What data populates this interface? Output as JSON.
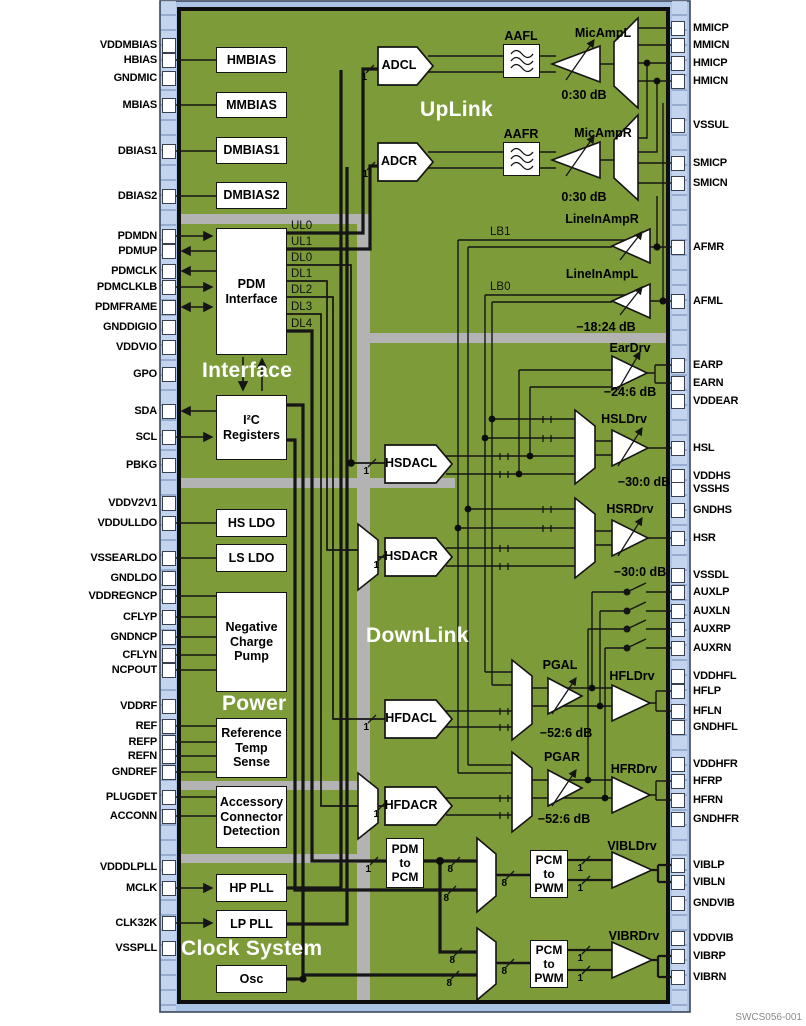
{
  "doc_code": "SWCS056-001",
  "sections": {
    "uplink": "UpLink",
    "downlink": "DownLink",
    "interface": "Interface",
    "power": "Power",
    "clock": "Clock System"
  },
  "blocks": {
    "hmbias": "HMBIAS",
    "mmbias": "MMBIAS",
    "dmbias1": "DMBIAS1",
    "dmbias2": "DMBIAS2",
    "pdm": {
      "l1": "PDM",
      "l2": "Interface"
    },
    "i2c": {
      "l1": "I²C",
      "l2": "Registers"
    },
    "hsldo": "HS LDO",
    "lsldo": "LS LDO",
    "ncp": {
      "l1": "Negative",
      "l2": "Charge",
      "l3": "Pump"
    },
    "ref": {
      "l1": "Reference",
      "l2": "Temp",
      "l3": "Sense"
    },
    "acc": {
      "l1": "Accessory",
      "l2": "Connector",
      "l3": "Detection"
    },
    "hppll": "HP PLL",
    "lppll": "LP PLL",
    "osc": "Osc",
    "adcl": "ADCL",
    "adcr": "ADCR",
    "aafl": "AAFL",
    "aafr": "AAFR",
    "hsdacl": "HSDACL",
    "hsdacr": "HSDACR",
    "hfdacl": "HFDACL",
    "hfdacr": "HFDACR",
    "pdm2pcm": {
      "l1": "PDM",
      "l2": "to",
      "l3": "PCM"
    },
    "pcm2pwm": {
      "l1": "PCM",
      "l2": "to",
      "l3": "PWM"
    }
  },
  "amps": {
    "micampl": "MicAmpL",
    "micampr": "MicAmpR",
    "lineinampr": "LineInAmpR",
    "lineinampl": "LineInAmpL",
    "eardrv": "EarDrv",
    "hsldrv": "HSLDrv",
    "hsrdrv": "HSRDrv",
    "pgal": "PGAL",
    "pgar": "PGAR",
    "hfldrv": "HFLDrv",
    "hfrdrv": "HFRDrv",
    "vibldrv": "VIBLDrv",
    "vibrdrv": "VIBRDrv"
  },
  "gains": {
    "mic": "0:30 dB",
    "linein": "−18:24 dB",
    "ear": "−24:6 dB",
    "hs": "−30:0 dB",
    "hf": "−52:6 dB"
  },
  "bus": {
    "ul0": "UL0",
    "ul1": "UL1",
    "dl0": "DL0",
    "dl1": "DL1",
    "dl2": "DL2",
    "dl3": "DL3",
    "dl4": "DL4",
    "lb0": "LB0",
    "lb1": "LB1",
    "w1": "1",
    "w8": "8"
  },
  "pins": {
    "left": [
      "VDDMBIAS",
      "HBIAS",
      "GNDMIC",
      "MBIAS",
      "DBIAS1",
      "DBIAS2",
      "PDMDN",
      "PDMUP",
      "PDMCLK",
      "PDMCLKLB",
      "PDMFRAME",
      "GNDDIGIO",
      "VDDVIO",
      "GPO",
      "SDA",
      "SCL",
      "PBKG",
      "VDDV2V1",
      "VDDULLDO",
      "VSSEARLDO",
      "GNDLDO",
      "VDDREGNCP",
      "CFLYP",
      "GNDNCP",
      "CFLYN",
      "NCPOUT",
      "VDDRF",
      "REF",
      "REFP",
      "REFN",
      "GNDREF",
      "PLUGDET",
      "ACCONN",
      "VDDDLPLL",
      "MCLK",
      "CLK32K",
      "VSSPLL"
    ],
    "right": [
      "MMICP",
      "MMICN",
      "HMICP",
      "HMICN",
      "VSSUL",
      "SMICP",
      "SMICN",
      "AFMR",
      "AFML",
      "EARP",
      "EARN",
      "VDDEAR",
      "HSL",
      "VDDHS",
      "VSSHS",
      "GNDHS",
      "HSR",
      "VSSDL",
      "AUXLP",
      "AUXLN",
      "AUXRP",
      "AUXRN",
      "VDDHFL",
      "HFLP",
      "HFLN",
      "GNDHFL",
      "VDDHFR",
      "HFRP",
      "HFRN",
      "GNDHFR",
      "VIBLP",
      "VIBLN",
      "GNDVIB",
      "VDDVIB",
      "VIBRP",
      "VIBRN"
    ]
  },
  "colors": {
    "chip": "#7d9b38",
    "frame": "#abc4e6",
    "band": "#b3b3b3",
    "wire": "#151515"
  }
}
